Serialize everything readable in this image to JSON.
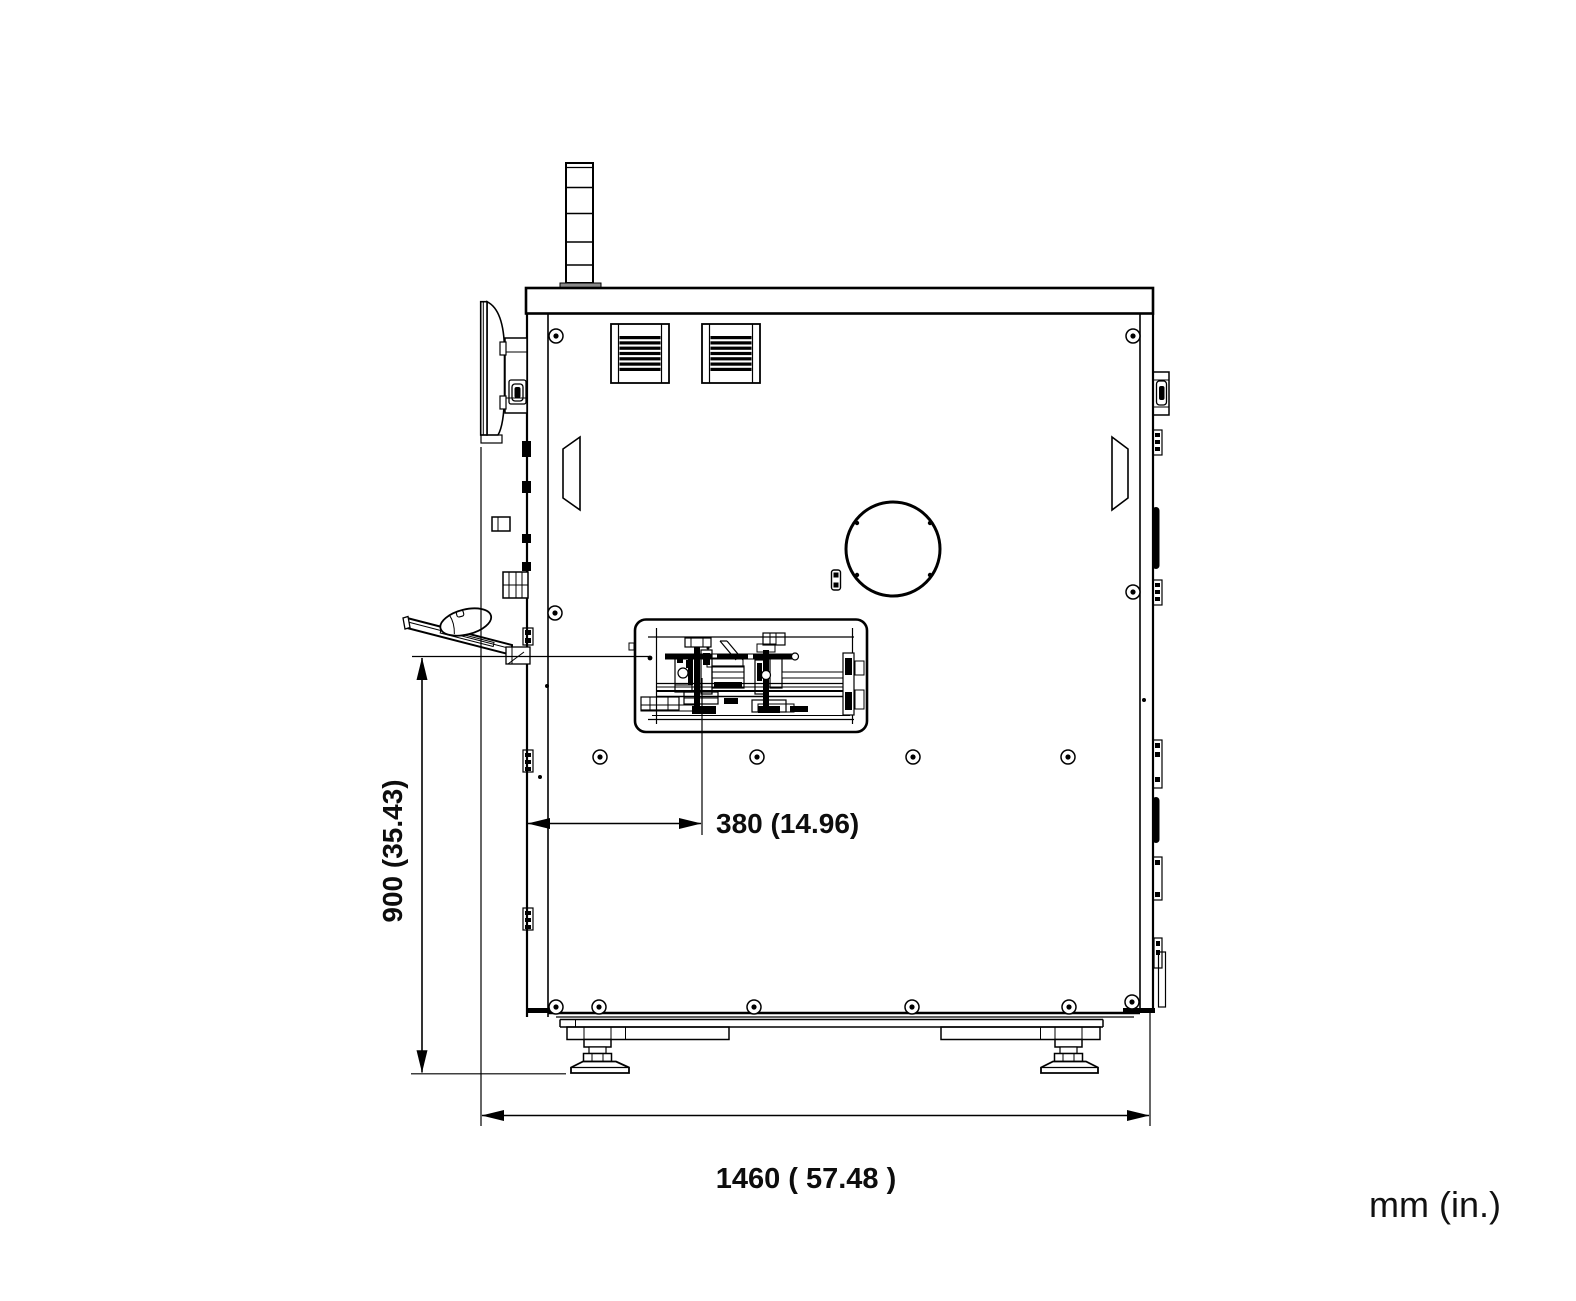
{
  "diagram": {
    "type": "technical-drawing",
    "view": "machine-side-elevation",
    "unit_label": "mm (in.)",
    "dimensions": [
      {
        "id": "work-height",
        "label": "900 (35.43)",
        "value_mm": 900,
        "value_in": 35.43,
        "orientation": "vertical"
      },
      {
        "id": "table-depth",
        "label": "380 (14.96)",
        "value_mm": 380,
        "value_in": 14.96,
        "orientation": "horizontal"
      },
      {
        "id": "overall-depth",
        "label": "1460 ( 57.48 )",
        "value_mm": 1460,
        "value_in": 57.48,
        "orientation": "horizontal"
      }
    ],
    "colors": {
      "line": "#000000",
      "background": "#ffffff"
    }
  }
}
